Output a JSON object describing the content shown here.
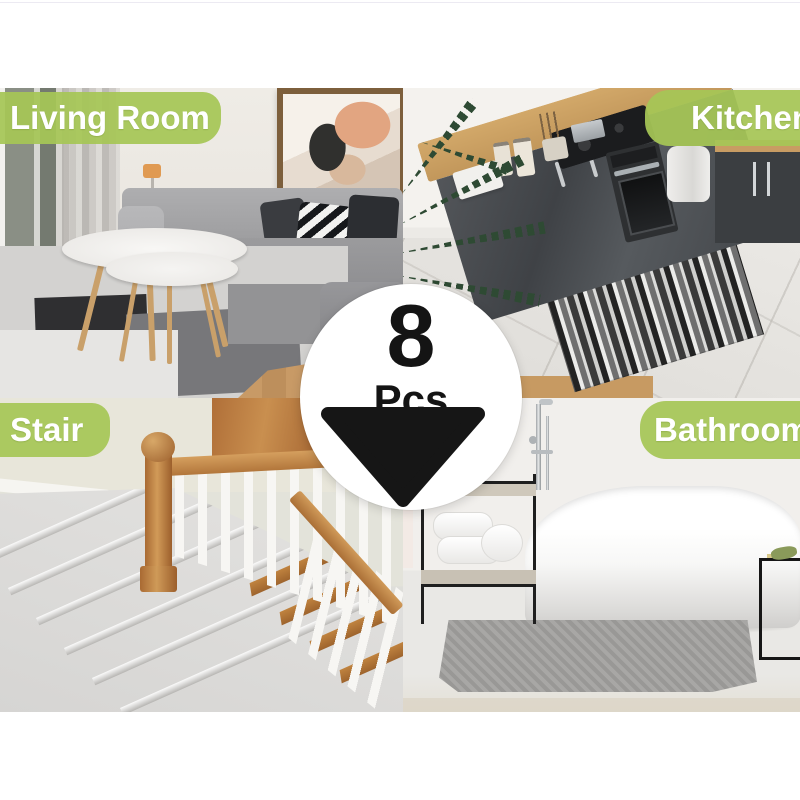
{
  "image_type": "product-collage",
  "background": "#ffffff",
  "accent_green": "#a6c656",
  "label_text_color": "#ffffff",
  "badge": {
    "count": "8",
    "unit": "Pcs",
    "circle_color": "#ffffff",
    "shape_color": "#161616",
    "shape": "triangle-corner-pad"
  },
  "sections": [
    {
      "id": "living-room",
      "label": "Living Room",
      "position": "top-left"
    },
    {
      "id": "kitchen",
      "label": "Kitchen",
      "position": "top-right"
    },
    {
      "id": "stair",
      "label": "Stair",
      "position": "bottom-left"
    },
    {
      "id": "bathroom",
      "label": "Bathroom",
      "position": "bottom-right"
    }
  ]
}
